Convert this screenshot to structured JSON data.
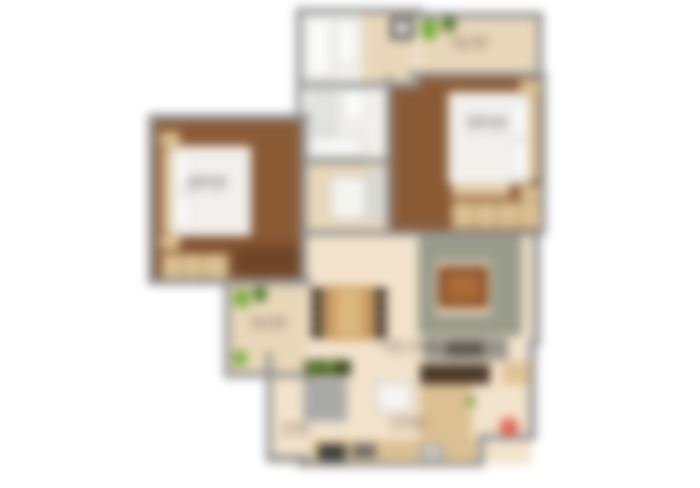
{
  "title": "2 BHK apartment floor plan (blurred)",
  "palette": {
    "wall": "#8f8f8f",
    "wood": "#8a5a35",
    "wood_dark": "#3a2d24",
    "living": "#f3e3cc",
    "balcony": "#e9d7ba",
    "tan": "#dcc093",
    "sofa": "#9a9c8b",
    "coffee": "#8b4f26",
    "plant": "#76ad3c",
    "plant_dark": "#4e772a",
    "red": "#dd4f44"
  },
  "rooms": {
    "bedroom_left": {
      "label": "BEDROOM",
      "dims": "10'6\" X 12'0\""
    },
    "bedroom_right": {
      "label": "BEDROOM",
      "dims": "11'0\" X 12'6\""
    },
    "living_dining": {
      "label": "LIVING / DINING",
      "dims": "11'0\" X 17'0\""
    },
    "kitchen": {
      "label": "KITCHEN",
      "dims": "8'0\" X 10'0\""
    },
    "balcony_top": {
      "label": "BALCONY",
      "dims": "9'0\" X 4'0\""
    },
    "balcony_left": {
      "label": "BALCONY",
      "dims": "5'0\" X 8'0\""
    },
    "foyer": {
      "label": "FOYER",
      "dims": "4'0\" X 6'0\""
    }
  }
}
